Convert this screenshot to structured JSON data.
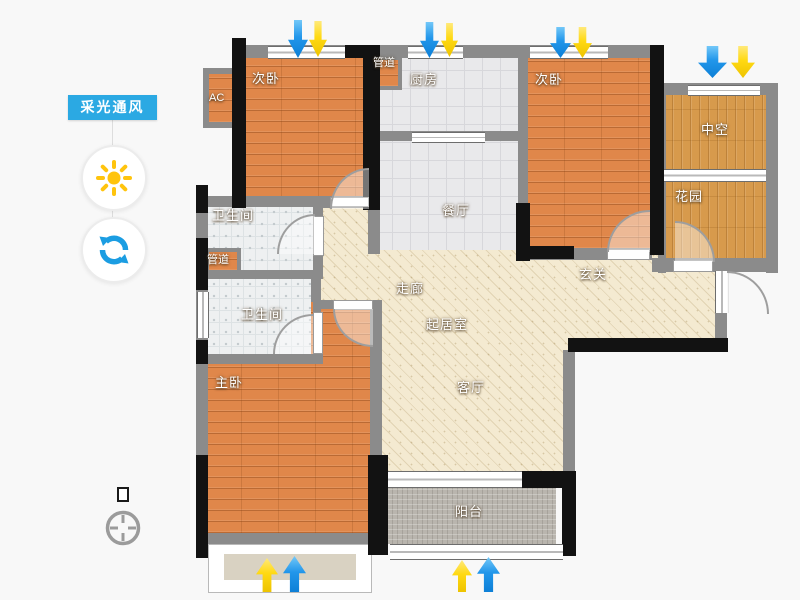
{
  "sidebar": {
    "toggle_label": "采光通风",
    "accent_color": "#2BA9E3",
    "icons": {
      "sun": "sun-icon",
      "rotate": "rotate-icon"
    }
  },
  "floorplan": {
    "rooms": {
      "bedroom_top_left": {
        "label": "次卧"
      },
      "ac_platform": {
        "label": "AC"
      },
      "duct_top": {
        "label": "管道"
      },
      "kitchen": {
        "label": "厨房"
      },
      "bedroom_top_right": {
        "label": "次卧"
      },
      "void_space": {
        "label": "中空"
      },
      "garden": {
        "label": "花园"
      },
      "bath_upper": {
        "label": "卫生间"
      },
      "duct_middle": {
        "label": "管道"
      },
      "bath_lower": {
        "label": "卫生间"
      },
      "master_bedroom": {
        "label": "主卧"
      },
      "dining_room": {
        "label": "餐厅"
      },
      "corridor": {
        "label": "走廊"
      },
      "entry_hall": {
        "label": "玄关"
      },
      "inner_living": {
        "label": "起居室"
      },
      "living_room": {
        "label": "客厅"
      },
      "balcony": {
        "label": "阳台"
      }
    },
    "arrow_colors": {
      "blue": "#2196EA",
      "yellow": "#FFD912"
    },
    "compass_icon": "compass-icon"
  },
  "colors": {
    "background": "#F8F8F8",
    "wall_gray": "#8B8B8B",
    "wall_black": "#121212",
    "wood_floor": "#E0874A",
    "golden_wood": "#D79A4C",
    "kitchen_tile": "#E9E9EB",
    "bath_tile": "#EEF0F1",
    "living_hatch": "#F4EAD1",
    "balcony_mosaic": "#B9B5AE"
  }
}
